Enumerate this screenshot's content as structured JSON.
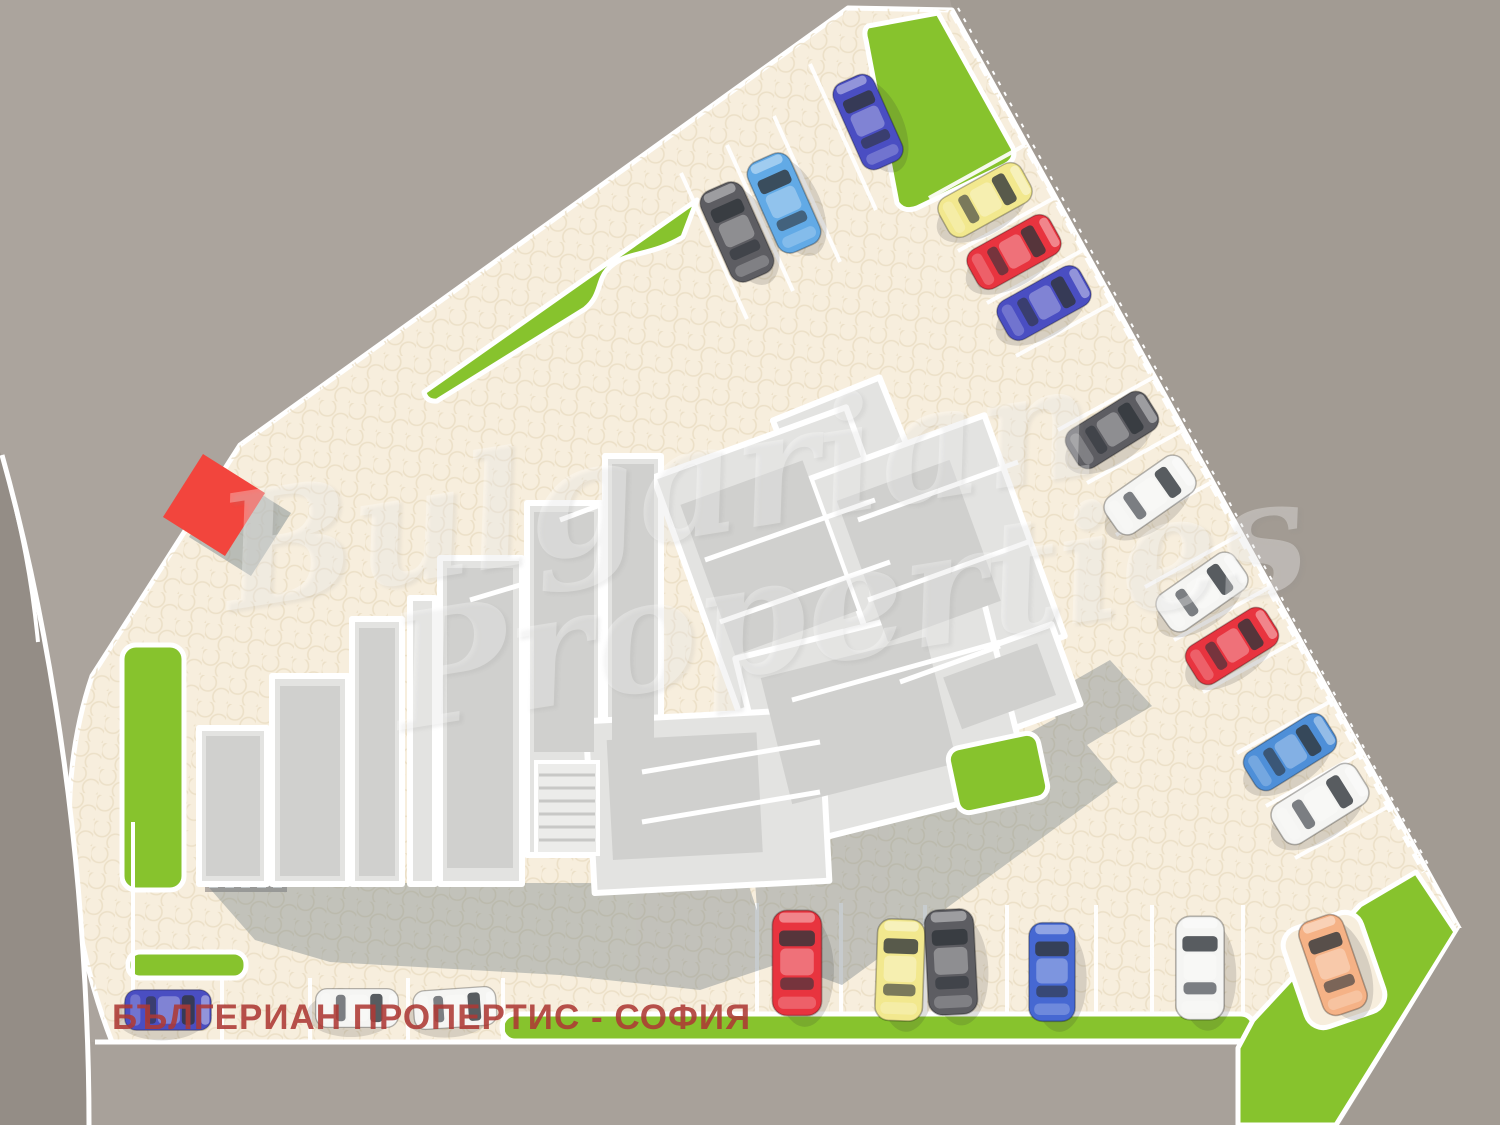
{
  "caption": {
    "text": "БЪЛГЕРИАН ПРОПЕРТИС - СОФИЯ",
    "color": "#ad3934"
  },
  "watermark": {
    "line1": "Bulgarian",
    "line2": "Properties"
  },
  "palette": {
    "pavement": "#f7eedd",
    "pavement_dot": "#e9dcc2",
    "grass": "#87c32d",
    "surround": "#aba49d",
    "surround_dark": "#a29b93",
    "road_left": "#948d86",
    "road_bottom": "#a8a19a",
    "curb": "#ffffff",
    "building_floor": "#e3e3e1",
    "building_inner": "#d0d0ce",
    "building_wall": "#ffffff",
    "building_shadow": "#6d7b82",
    "red_marker": "#f2453d"
  },
  "cars": {
    "count": 21,
    "colors": {
      "blue": "#4a4ec2",
      "royal": "#4668d2",
      "steelblue": "#4e8fd8",
      "lightblue": "#62aae6",
      "darkgray": "#5d5d62",
      "white": "#f5f5f3",
      "yellow": "#f2e88e",
      "red": "#e8343f",
      "orange": "#f5b286"
    },
    "items": [
      {
        "id": "car-1",
        "color": "darkgray",
        "x": 737,
        "y": 232,
        "r": -24,
        "s": 1.05
      },
      {
        "id": "car-2",
        "color": "lightblue",
        "x": 784,
        "y": 203,
        "r": -24,
        "s": 1.05
      },
      {
        "id": "car-3",
        "color": "blue",
        "x": 868,
        "y": 122,
        "r": -24,
        "s": 1.0
      },
      {
        "id": "car-4",
        "color": "yellow",
        "x": 985,
        "y": 200,
        "r": 61,
        "s": 1.0
      },
      {
        "id": "car-5",
        "color": "red",
        "x": 1014,
        "y": 252,
        "r": 61,
        "s": 1.0
      },
      {
        "id": "car-6",
        "color": "blue",
        "x": 1044,
        "y": 303,
        "r": 61,
        "s": 1.0
      },
      {
        "id": "car-7",
        "color": "darkgray",
        "x": 1112,
        "y": 430,
        "r": 58,
        "s": 1.0
      },
      {
        "id": "car-8",
        "color": "white",
        "x": 1150,
        "y": 495,
        "r": 55,
        "s": 1.0
      },
      {
        "id": "car-9",
        "color": "white",
        "x": 1202,
        "y": 592,
        "r": 55,
        "s": 1.0
      },
      {
        "id": "car-10",
        "color": "red",
        "x": 1232,
        "y": 646,
        "r": 58,
        "s": 1.0
      },
      {
        "id": "car-11",
        "color": "steelblue",
        "x": 1290,
        "y": 752,
        "r": 58,
        "s": 1.0
      },
      {
        "id": "car-12",
        "color": "white",
        "x": 1320,
        "y": 804,
        "r": 58,
        "s": 1.05
      },
      {
        "id": "car-13",
        "color": "red",
        "x": 797,
        "y": 963,
        "r": 0,
        "s": 1.12
      },
      {
        "id": "car-14",
        "color": "yellow",
        "x": 900,
        "y": 970,
        "r": 2,
        "s": 1.08
      },
      {
        "id": "car-15",
        "color": "darkgray",
        "x": 951,
        "y": 962,
        "r": -3,
        "s": 1.12
      },
      {
        "id": "car-16",
        "color": "royal",
        "x": 1052,
        "y": 972,
        "r": 0,
        "s": 1.05
      },
      {
        "id": "car-17",
        "color": "white",
        "x": 1200,
        "y": 968,
        "r": 0,
        "s": 1.1
      },
      {
        "id": "car-18",
        "color": "orange",
        "x": 1333,
        "y": 965,
        "r": -19,
        "s": 1.05
      },
      {
        "id": "car-19",
        "color": "blue",
        "x": 168,
        "y": 1010,
        "r": 90,
        "s": 0.92
      },
      {
        "id": "car-20",
        "color": "white",
        "x": 357,
        "y": 1008,
        "r": 90,
        "s": 0.88
      },
      {
        "id": "car-21",
        "color": "white",
        "x": 455,
        "y": 1008,
        "r": 86,
        "s": 0.88
      }
    ]
  }
}
